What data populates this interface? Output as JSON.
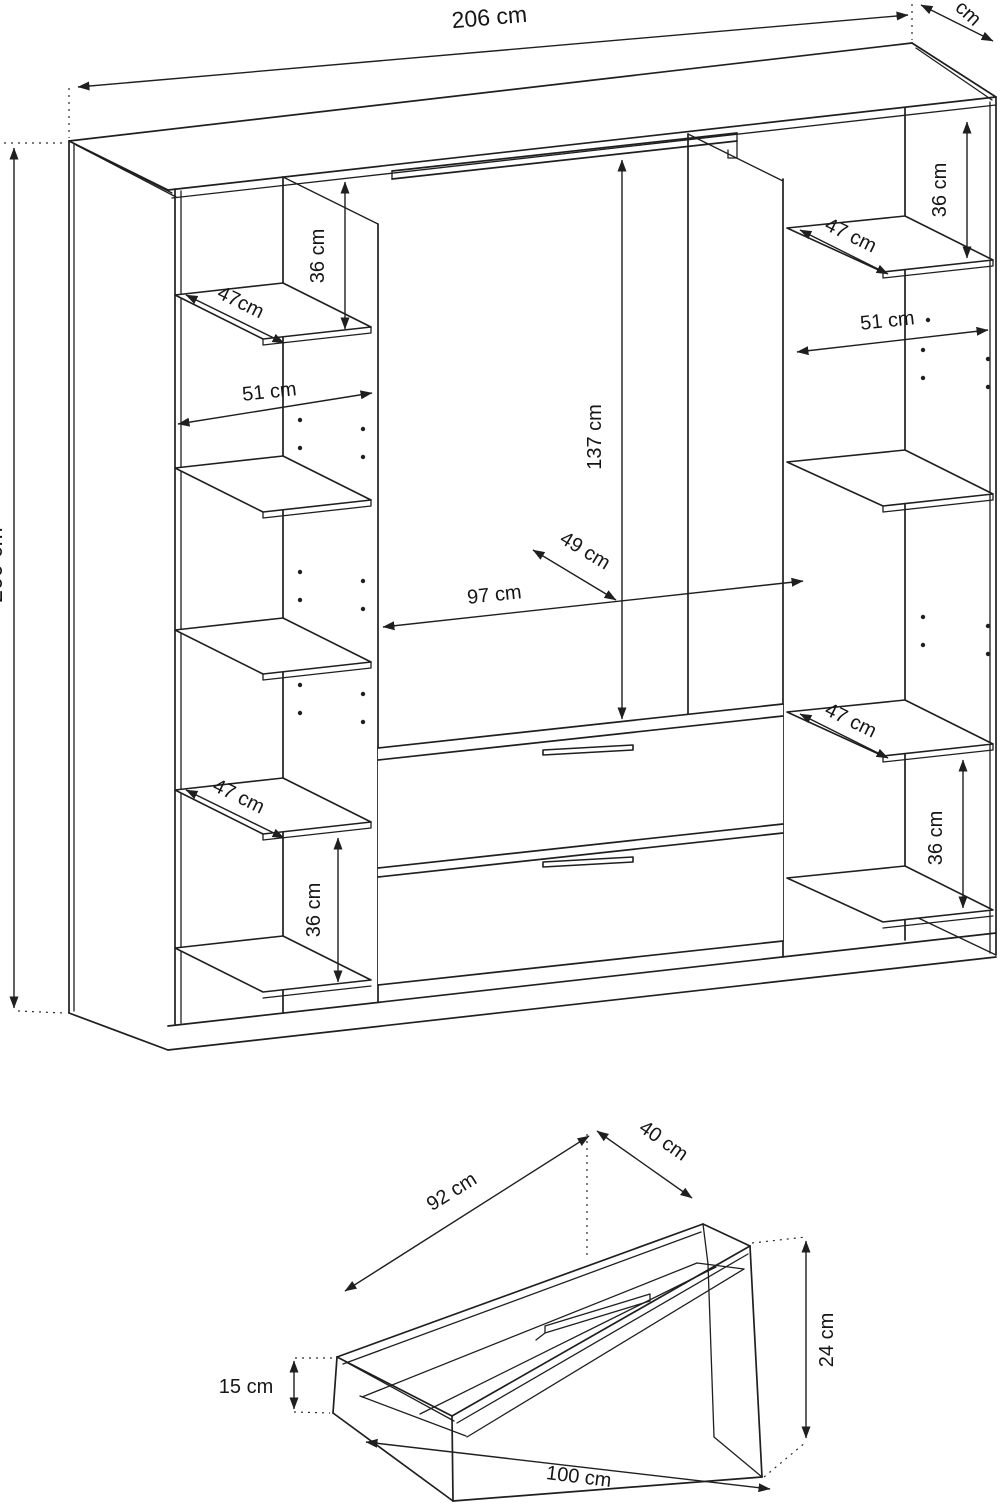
{
  "wardrobe": {
    "overall": {
      "width": "206 cm",
      "height": "200 cm",
      "depth_partial": "cm"
    },
    "left_column": {
      "top_gap_height": "36 cm",
      "top_shelf_depth": "47cm",
      "inner_width": "51 cm",
      "bottom_shelf_depth": "47 cm",
      "bottom_gap_height": "36 cm"
    },
    "middle_section": {
      "hanging_height": "137 cm",
      "hanging_depth": "49 cm",
      "inner_width": "97 cm"
    },
    "right_column": {
      "top_shelf_depth": "47 cm",
      "top_gap_height": "36 cm",
      "inner_width": "51 cm",
      "bottom_shelf_depth": "47 cm",
      "bottom_gap_height": "36 cm"
    }
  },
  "drawer": {
    "inner_width": "92 cm",
    "inner_depth": "40 cm",
    "front_height": "24 cm",
    "back_height": "15 cm",
    "outer_width": "100 cm"
  }
}
